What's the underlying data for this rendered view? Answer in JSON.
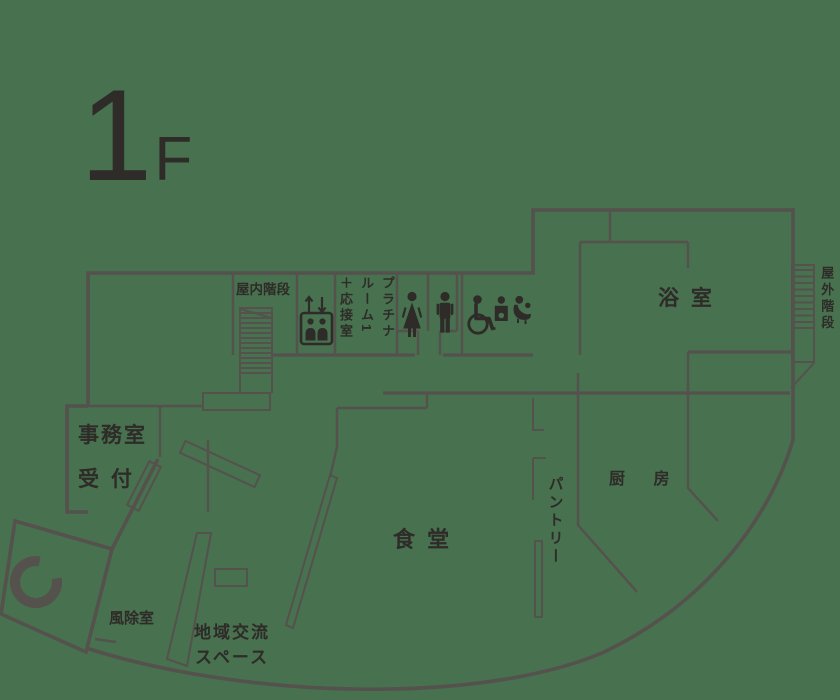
{
  "colors": {
    "background": "#47714F",
    "wall": "#55514D",
    "ink": "#2E2B28"
  },
  "floor": {
    "number": "1",
    "suffix": "F"
  },
  "labels": {
    "indoor_stairs": "屋内階段",
    "platinum_cols": [
      "プラチナ",
      "ルーム1",
      "＋応接室"
    ],
    "bath": "浴 室",
    "outdoor_stairs": "屋外階段",
    "office": "事務室",
    "reception": "受 付",
    "dining": "食 堂",
    "pantry": "パントリー",
    "kitchen": "厨 房",
    "windbreak": "風除室",
    "community_line1": "地域交流",
    "community_line2": "スペース"
  },
  "icons": [
    "elevator-icon",
    "elevator-up-arrow-icon",
    "elevator-down-arrow-icon",
    "female-toilet-icon",
    "male-toilet-icon",
    "wheelchair-icon",
    "ostomate-icon",
    "baby-care-icon",
    "revolving-door-icon",
    "indoor-stairs-hatch",
    "outdoor-stairs-hatch"
  ]
}
